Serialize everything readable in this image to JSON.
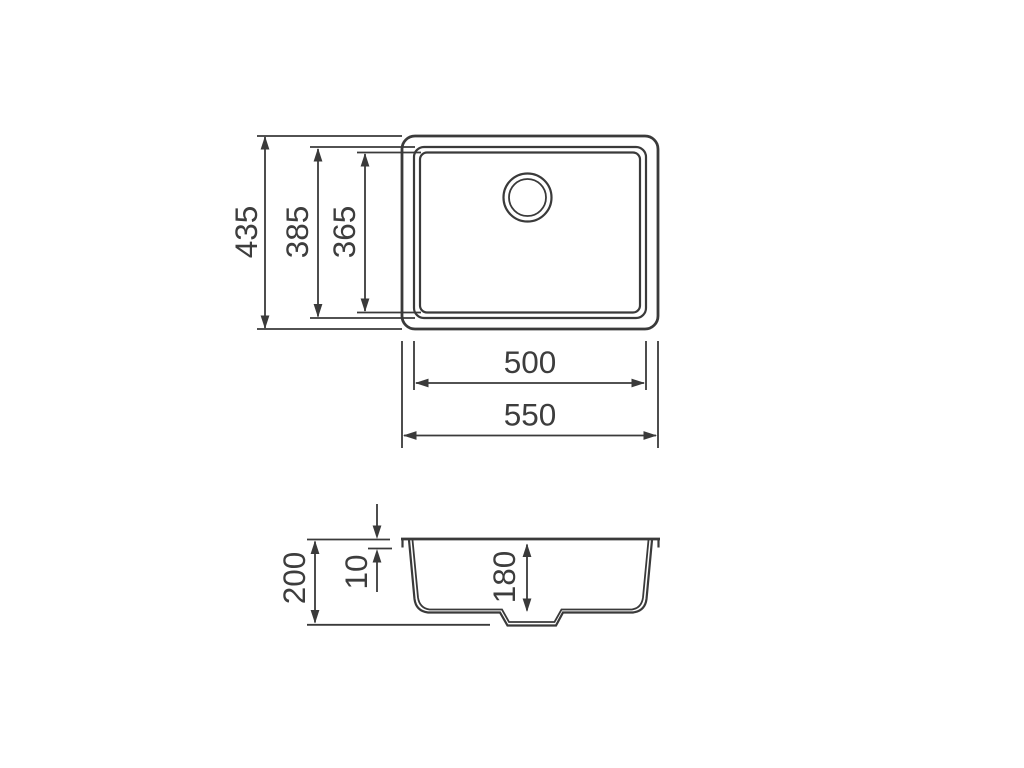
{
  "drawing": {
    "kind": "sink-dimension-drawing",
    "line_color": "#3a3a3a",
    "background": "#ffffff",
    "top_view": {
      "dimensions": {
        "overall_height": "435",
        "rim_opening_height": "385",
        "bowl_inner_height": "365",
        "bowl_inner_width": "500",
        "overall_width": "550"
      }
    },
    "side_view": {
      "dimensions": {
        "overall_depth": "200",
        "rim_thickness": "10",
        "bowl_depth": "180"
      }
    }
  }
}
